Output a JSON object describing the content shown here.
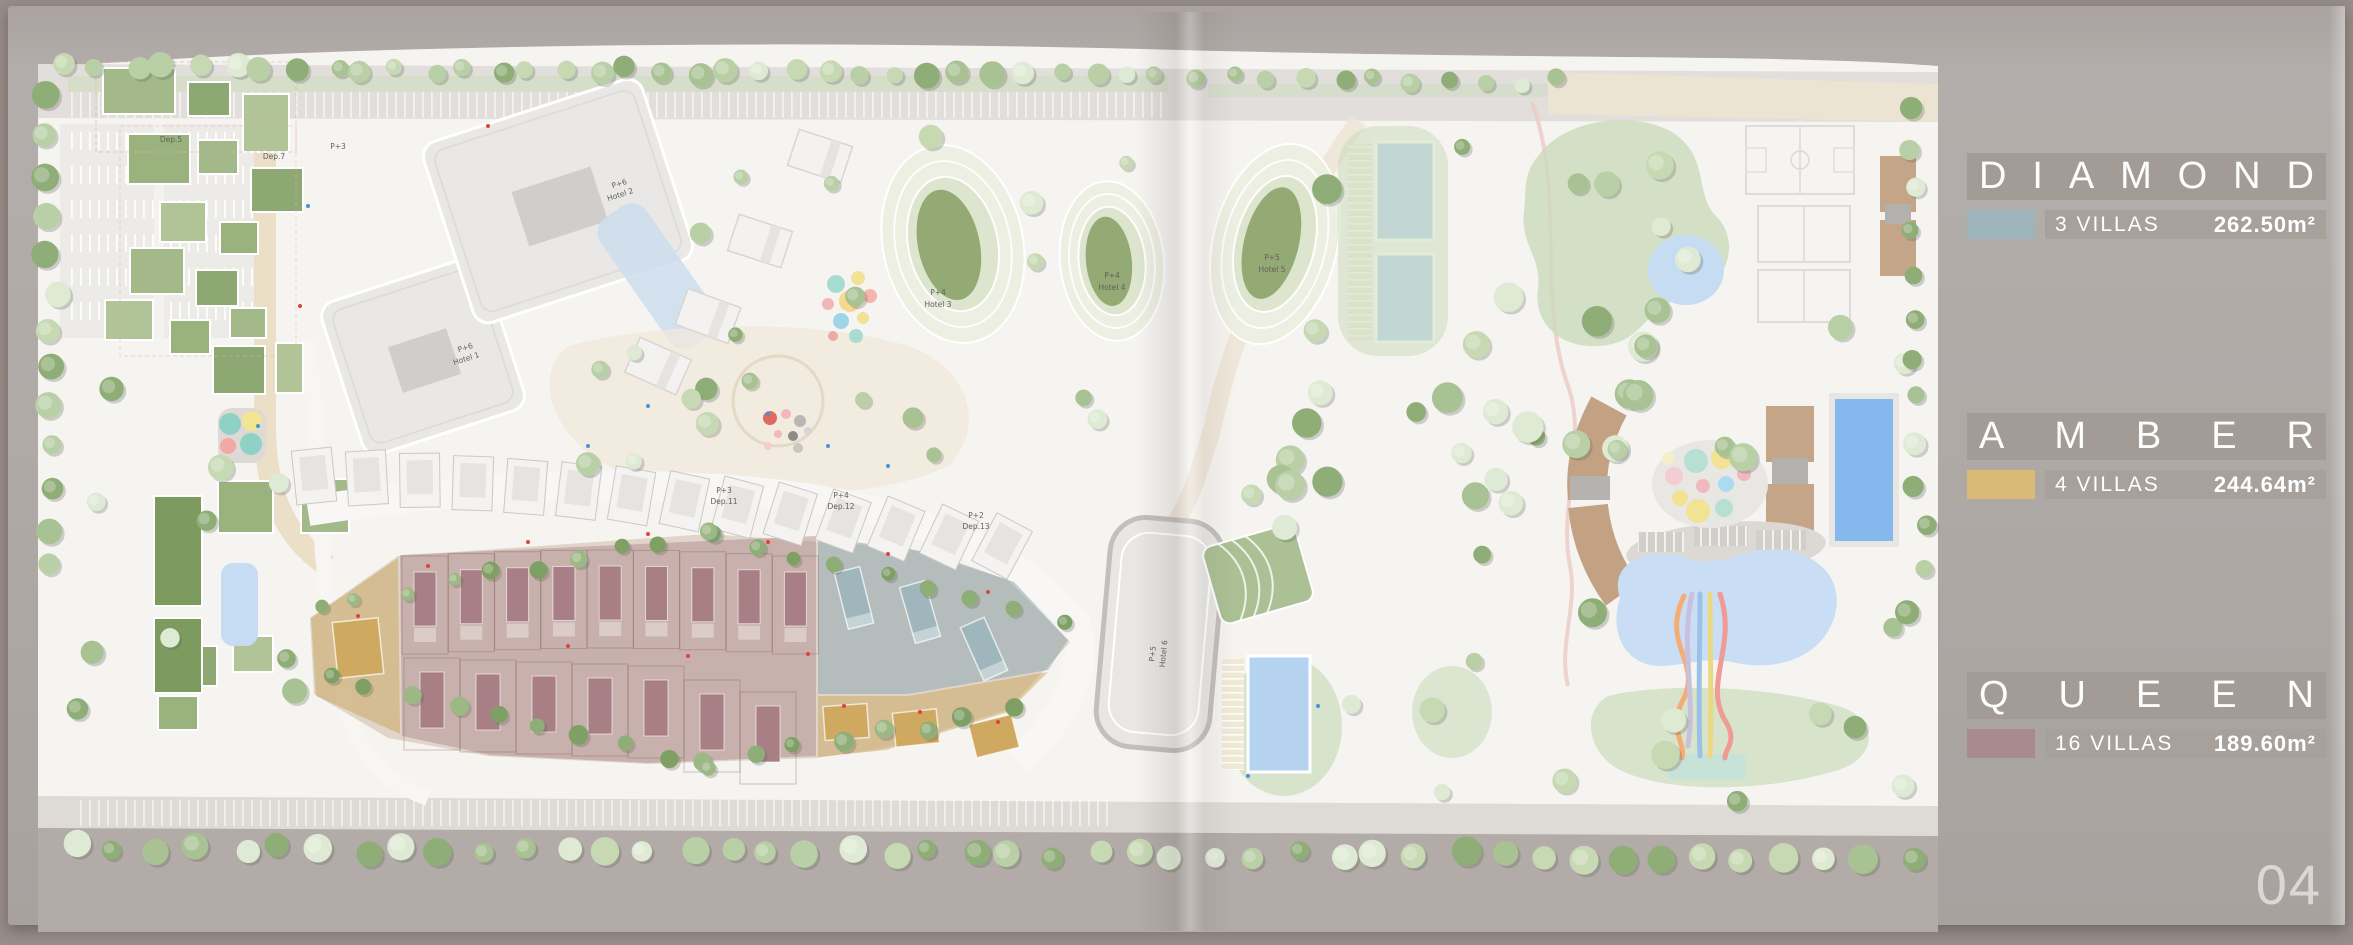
{
  "page": {
    "number": "04"
  },
  "legend": {
    "entries": [
      {
        "id": "diamond",
        "title": "DIAMOND",
        "count_label": "3 VILLAS",
        "area_label": "262.50m²",
        "swatch_color": "#9db4ba"
      },
      {
        "id": "amber",
        "title": "AMBER",
        "count_label": "4 VILLAS",
        "area_label": "244.64m²",
        "swatch_color": "#d9ba76"
      },
      {
        "id": "queen",
        "title": "QUEEN",
        "count_label": "16 VILLAS",
        "area_label": "189.60m²",
        "swatch_color": "#a78b8e"
      }
    ]
  },
  "map": {
    "zone_colors": {
      "diamond": "#8fa9b1",
      "amber": "#c9a55e",
      "queen": "#b08b90"
    },
    "villa_colors": {
      "diamond": "#9fb6bd",
      "amber": "#cfa95f",
      "queen": "#a87f85"
    },
    "labels": [
      {
        "text": "P+6",
        "x": 458,
        "y": 344,
        "r": -18
      },
      {
        "text": "Hotel 1",
        "x": 459,
        "y": 355,
        "r": -18
      },
      {
        "text": "P+6",
        "x": 612,
        "y": 180,
        "r": -18
      },
      {
        "text": "Hotel 2",
        "x": 613,
        "y": 191,
        "r": -18
      },
      {
        "text": "P+4",
        "x": 930,
        "y": 289,
        "r": 0
      },
      {
        "text": "Hotel 3",
        "x": 930,
        "y": 301,
        "r": 0
      },
      {
        "text": "P+4",
        "x": 1104,
        "y": 272,
        "r": 0
      },
      {
        "text": "Hotel 4",
        "x": 1104,
        "y": 284,
        "r": 0
      },
      {
        "text": "P+5",
        "x": 1264,
        "y": 254,
        "r": 0
      },
      {
        "text": "Hotel 5",
        "x": 1264,
        "y": 266,
        "r": 0
      },
      {
        "text": "P+5",
        "x": 1147,
        "y": 648,
        "r": -84
      },
      {
        "text": "Hotel 6",
        "x": 1158,
        "y": 648,
        "r": -84
      },
      {
        "text": "P+3",
        "x": 716,
        "y": 487,
        "r": 0
      },
      {
        "text": "Dep.11",
        "x": 716,
        "y": 498,
        "r": 0
      },
      {
        "text": "P+4",
        "x": 833,
        "y": 492,
        "r": 0
      },
      {
        "text": "Dep.12",
        "x": 833,
        "y": 503,
        "r": 0
      },
      {
        "text": "P+2",
        "x": 968,
        "y": 512,
        "r": 0
      },
      {
        "text": "Dep.13",
        "x": 968,
        "y": 523,
        "r": 0
      },
      {
        "text": "Dep.5",
        "x": 163,
        "y": 136,
        "r": 0
      },
      {
        "text": "Dep.7",
        "x": 266,
        "y": 153,
        "r": 0
      },
      {
        "text": "P+3",
        "x": 330,
        "y": 143,
        "r": 0
      }
    ]
  }
}
